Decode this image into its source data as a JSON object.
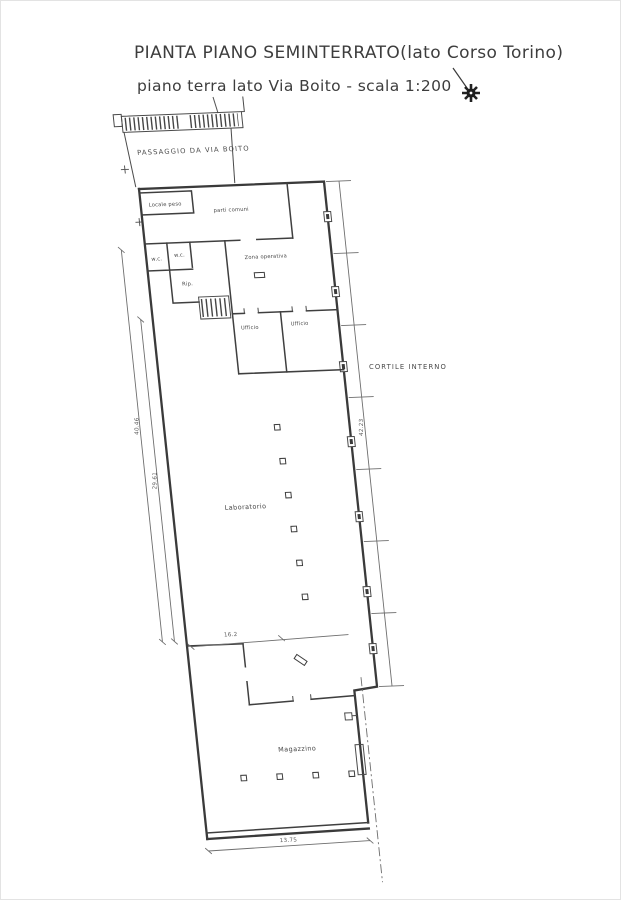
{
  "page": {
    "background": "#ffffff",
    "line_color": "#3a3a3a",
    "dim_color": "#6e6e6e",
    "text_color": "#3d3d3d"
  },
  "title": {
    "line1": "PIANTA PIANO SEMINTERRATO(lato Corso Torino)",
    "line2": "piano terra lato Via Boito - scala 1:200"
  },
  "compass": {
    "icon": "north-compass-icon"
  },
  "plan": {
    "passage_label": "PASSAGGIO DA VIA BOITO",
    "courtyard_label": "CORTILE INTERNO",
    "rooms": {
      "locale_peso": "Locale peso",
      "parti_comuni": "parti comuni",
      "zona_operativa": "Zona operativa",
      "wc1": "w.c.",
      "wc2": "w.c.",
      "rip": "Rip.",
      "ufficio1": "Ufficio",
      "ufficio2": "Ufficio",
      "laboratorio": "Laboratorio",
      "magazzino": "Magazzino"
    },
    "dimensions": {
      "left_outer": "40.46",
      "left_inner": "29.61",
      "right_side": "42.23",
      "middle": "16.2",
      "bottom": "13.75"
    }
  }
}
